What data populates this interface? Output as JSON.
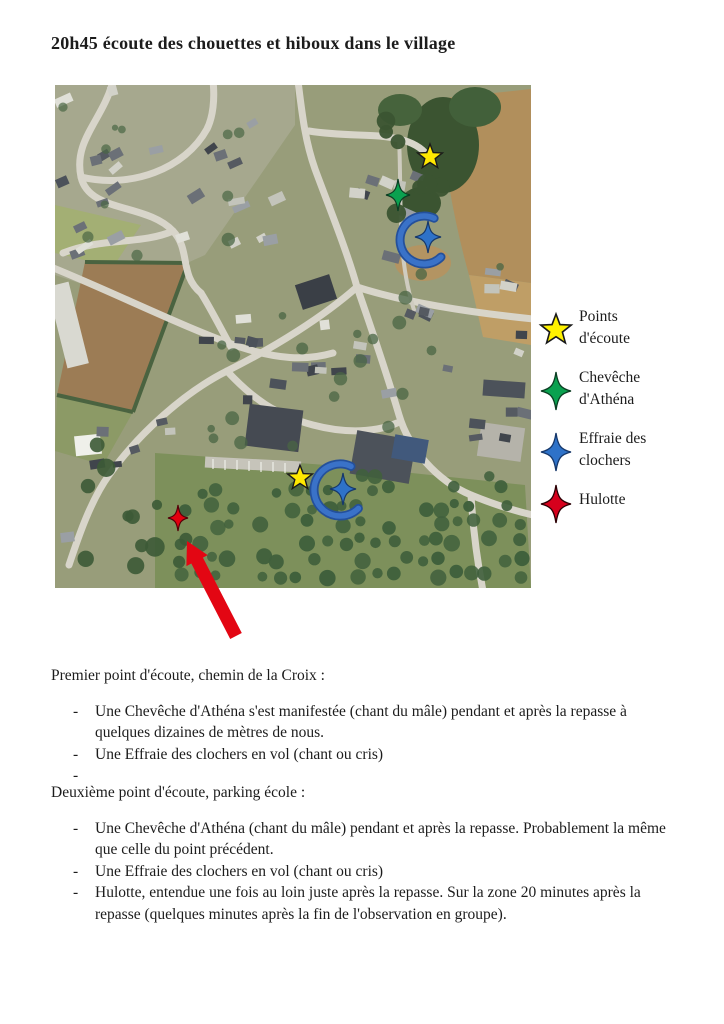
{
  "doc": {
    "title": "20h45 écoute des chouettes et hiboux dans le village"
  },
  "chars": {
    "dash": "-"
  },
  "map": {
    "description": "Vue aérienne du village avec points d'écoute et observations",
    "markers": [
      {
        "name": "point-ecoute-1",
        "shape": "star5",
        "color": "#ffe900",
        "stroke": "#1a1a1a",
        "x": 375,
        "y": 72,
        "size": 13
      },
      {
        "name": "cheveche-athena",
        "shape": "star4",
        "color": "#0aa14f",
        "stroke": "#0b3d22",
        "x": 343,
        "y": 110,
        "w": 12,
        "h": 16
      },
      {
        "name": "effraie-clochers-1",
        "shape": "star4",
        "color": "#2e72c8",
        "stroke": "#16386b",
        "x": 373,
        "y": 152,
        "w": 13,
        "h": 16
      },
      {
        "name": "point-ecoute-2",
        "shape": "star5",
        "color": "#ffe900",
        "stroke": "#1a1a1a",
        "x": 245,
        "y": 393,
        "size": 13
      },
      {
        "name": "effraie-clochers-2",
        "shape": "star4",
        "color": "#2e72c8",
        "stroke": "#16386b",
        "x": 288,
        "y": 404,
        "w": 13,
        "h": 16
      },
      {
        "name": "hulotte",
        "shape": "star4",
        "color": "#e3000f",
        "stroke": "#550008",
        "x": 123,
        "y": 433,
        "w": 10,
        "h": 13
      }
    ],
    "arcs": [
      {
        "name": "flight-arc-1",
        "cx": 369,
        "cy": 155,
        "r": 24,
        "color": "#3a72c8",
        "edge": "#24509b"
      },
      {
        "name": "flight-arc-2",
        "cx": 285,
        "cy": 405,
        "r": 26,
        "color": "#3a72c8",
        "edge": "#24509b"
      }
    ],
    "arrow": {
      "name": "location-arrow",
      "tip": [
        132,
        456
      ],
      "tail": [
        181,
        551
      ],
      "color": "#e30613"
    }
  },
  "legend": {
    "items": [
      {
        "name": "points-ecoute",
        "shape": "star5",
        "color": "#fff200",
        "stroke": "#1a1a1a",
        "label": "Points\nd'écoute"
      },
      {
        "name": "cheveche-athena",
        "shape": "star4",
        "color": "#0aa14f",
        "stroke": "#0b3d22",
        "label": "Chevêche\nd'Athéna"
      },
      {
        "name": "effraie-clochers",
        "shape": "star4",
        "color": "#2e72c8",
        "stroke": "#16386b",
        "label": "Effraie des\nclochers"
      },
      {
        "name": "hulotte",
        "shape": "star4",
        "color": "#d6001c",
        "stroke": "#2b0004",
        "label": "Hulotte"
      }
    ]
  },
  "sections": [
    {
      "heading": "Premier point d'écoute, chemin de la Croix :",
      "bullets": [
        "Une Chevêche d'Athéna s'est manifestée (chant du mâle) pendant et après la repasse à quelques dizaines de mètres de nous.",
        "Une Effraie des clochers en vol (chant ou cris)",
        ""
      ]
    },
    {
      "heading": "Deuxième point d'écoute, parking école :",
      "bullets": [
        "Une Chevêche d'Athéna (chant du mâle) pendant et après la repasse. Probablement la même que celle du point précédent.",
        "Une Effraie des clochers en vol (chant ou cris)",
        "Hulotte, entendue une fois au loin juste après la repasse. Sur la zone 20 minutes après la repasse (quelques minutes après la fin de l'observation en groupe)."
      ]
    }
  ]
}
